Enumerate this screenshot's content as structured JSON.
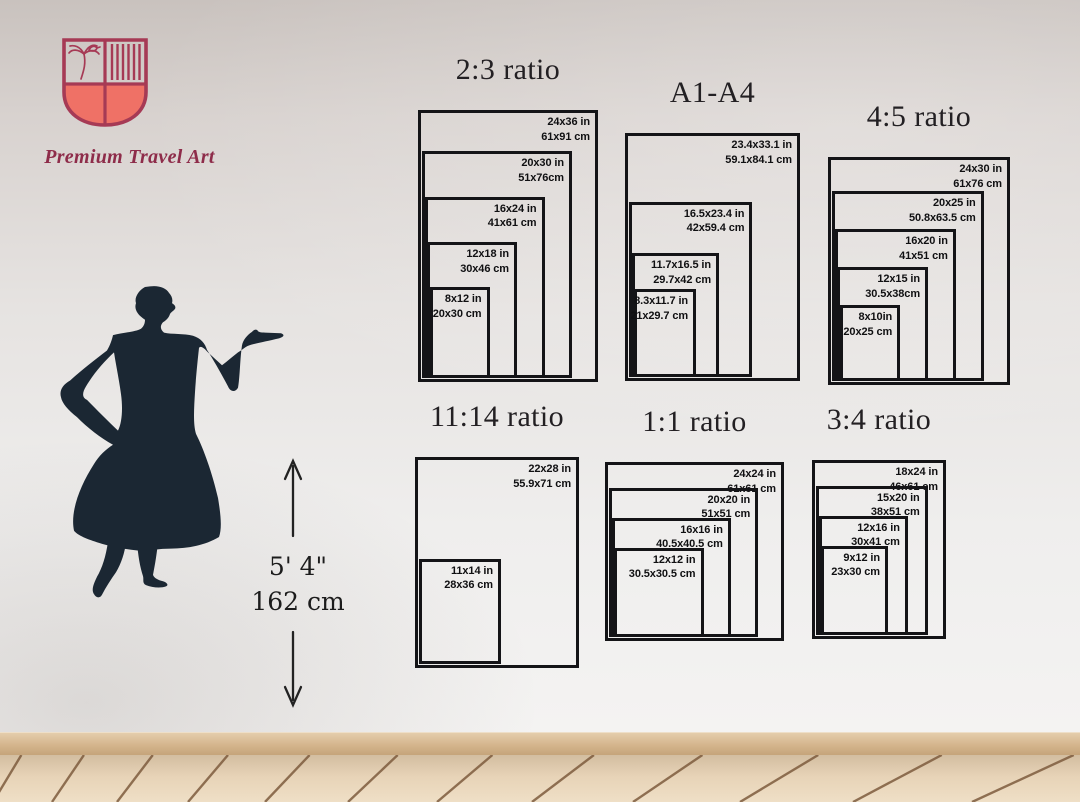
{
  "brand": {
    "name": "Premium Travel Art"
  },
  "height_indicator": {
    "imperial": "5' 4\"",
    "metric": "162 cm"
  },
  "colors": {
    "accent_maroon": "#a03a56",
    "accent_coral": "#ef7166",
    "box_line": "#141417",
    "silhouette": "#1b2733",
    "floor_seam": "#7e5c3e"
  },
  "groups": [
    {
      "id": "ratio-2-3",
      "title": "2:3 ratio",
      "sizes": [
        {
          "inches": "24x36 in",
          "cm": "61x91 cm",
          "w_in": 24,
          "h_in": 36
        },
        {
          "inches": "20x30 in",
          "cm": "51x76cm",
          "w_in": 20,
          "h_in": 30
        },
        {
          "inches": "16x24 in",
          "cm": "41x61 cm",
          "w_in": 16,
          "h_in": 24
        },
        {
          "inches": "12x18 in",
          "cm": "30x46 cm",
          "w_in": 12,
          "h_in": 18
        },
        {
          "inches": "8x12 in",
          "cm": "20x30 cm",
          "w_in": 8,
          "h_in": 12
        }
      ]
    },
    {
      "id": "a1-a4",
      "title": "A1-A4",
      "sizes": [
        {
          "inches": "23.4x33.1 in",
          "cm": "59.1x84.1 cm",
          "w_in": 23.4,
          "h_in": 33.1
        },
        {
          "inches": "16.5x23.4 in",
          "cm": "42x59.4 cm",
          "w_in": 16.5,
          "h_in": 23.4
        },
        {
          "inches": "11.7x16.5 in",
          "cm": "29.7x42 cm",
          "w_in": 11.7,
          "h_in": 16.5
        },
        {
          "inches": "8.3x11.7 in",
          "cm": "21x29.7 cm",
          "w_in": 8.3,
          "h_in": 11.7
        }
      ]
    },
    {
      "id": "ratio-4-5",
      "title": "4:5 ratio",
      "sizes": [
        {
          "inches": "24x30 in",
          "cm": "61x76 cm",
          "w_in": 24,
          "h_in": 30
        },
        {
          "inches": "20x25 in",
          "cm": "50.8x63.5 cm",
          "w_in": 20,
          "h_in": 25
        },
        {
          "inches": "16x20 in",
          "cm": "41x51 cm",
          "w_in": 16,
          "h_in": 20
        },
        {
          "inches": "12x15 in",
          "cm": "30.5x38cm",
          "w_in": 12,
          "h_in": 15
        },
        {
          "inches": "8x10in",
          "cm": "20x25 cm",
          "w_in": 8,
          "h_in": 10
        }
      ]
    },
    {
      "id": "ratio-11-14",
      "title": "11:14 ratio",
      "sizes": [
        {
          "inches": "22x28 in",
          "cm": "55.9x71 cm",
          "w_in": 22,
          "h_in": 28
        },
        {
          "inches": "11x14 in",
          "cm": "28x36 cm",
          "w_in": 11,
          "h_in": 14
        }
      ]
    },
    {
      "id": "ratio-1-1",
      "title": "1:1 ratio",
      "sizes": [
        {
          "inches": "24x24 in",
          "cm": "61x61 cm",
          "w_in": 24,
          "h_in": 24
        },
        {
          "inches": "20x20 in",
          "cm": "51x51 cm",
          "w_in": 20,
          "h_in": 20
        },
        {
          "inches": "16x16 in",
          "cm": "40.5x40.5 cm",
          "w_in": 16,
          "h_in": 16
        },
        {
          "inches": "12x12 in",
          "cm": "30.5x30.5 cm",
          "w_in": 12,
          "h_in": 12
        }
      ]
    },
    {
      "id": "ratio-3-4",
      "title": "3:4 ratio",
      "sizes": [
        {
          "inches": "18x24 in",
          "cm": "46x61 cm",
          "w_in": 18,
          "h_in": 24
        },
        {
          "inches": "15x20 in",
          "cm": "38x51 cm",
          "w_in": 15,
          "h_in": 20
        },
        {
          "inches": "12x16 in",
          "cm": "30x41 cm",
          "w_in": 12,
          "h_in": 16
        },
        {
          "inches": "9x12 in",
          "cm": "23x30 cm",
          "w_in": 9,
          "h_in": 12
        }
      ]
    }
  ]
}
